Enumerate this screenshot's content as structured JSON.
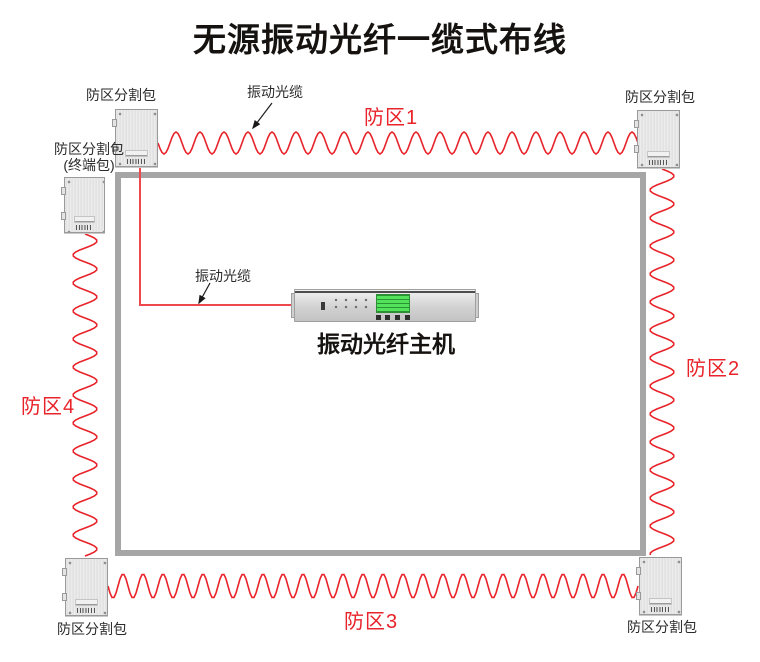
{
  "title": "无源振动光纤一缆式布线",
  "zones": {
    "zone1": "防区1",
    "zone2": "防区2",
    "zone3": "防区3",
    "zone4": "防区4"
  },
  "components": {
    "splitter_top_left": "防区分割包",
    "splitter_top_right": "防区分割包",
    "splitter_bottom_left": "防区分割包",
    "splitter_bottom_right": "防区分割包",
    "terminal_splitter_line1": "防区分割包",
    "terminal_splitter_line2": "(终端包)",
    "host": "振动光纤主机"
  },
  "annotations": {
    "cable_top": "振动光缆",
    "cable_host": "振动光缆"
  },
  "colors": {
    "zone_label_red": "#e8232a",
    "cable_red": "#e8232a",
    "perimeter_gray": "#a6a6a6",
    "title_black": "#151210",
    "host_screen_green": "#52e25c"
  }
}
